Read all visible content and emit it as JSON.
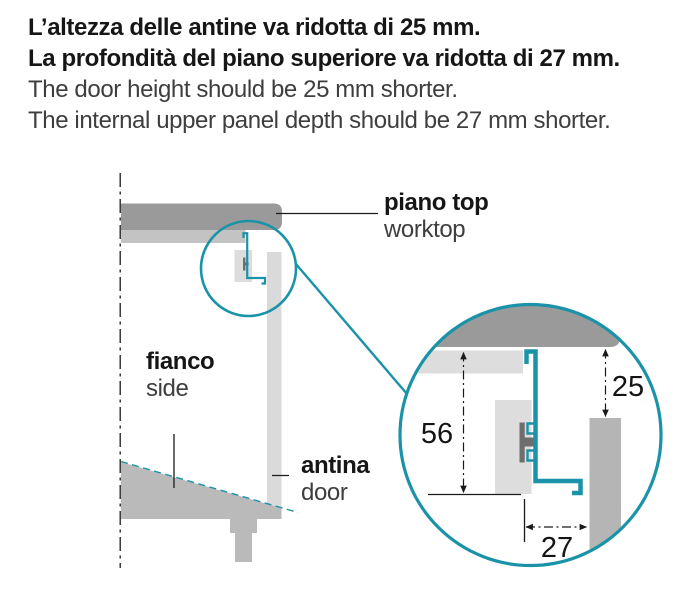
{
  "header": {
    "it_line1": "L’altezza delle antine va ridotta di 25 mm.",
    "it_line2": "La profondità del piano superiore va ridotta di 27 mm.",
    "en_line1": "The door height should be 25 mm shorter.",
    "en_line2": "The internal upper panel depth should be 27 mm shorter."
  },
  "labels": {
    "worktop_it": "piano top",
    "worktop_en": "worktop",
    "side_it": "fianco",
    "side_en": "side",
    "door_it": "antina",
    "door_en": "door"
  },
  "dimensions": {
    "side_panel_height": "56",
    "door_offset": "25",
    "top_panel_depth": "27"
  },
  "colors": {
    "accent_teal": "#1a93a8",
    "worktop_dark_gray": "#9a9a9a",
    "sub_panel_gray": "#c3c3c3",
    "door_light_gray": "#dadada",
    "plinth_gray": "#bababa",
    "panel_pale_gray": "#dddddd",
    "door_mid_gray": "#b5b5b5",
    "clip_dark_gray": "#6e6e6e",
    "line_black": "#1a1a1a"
  }
}
